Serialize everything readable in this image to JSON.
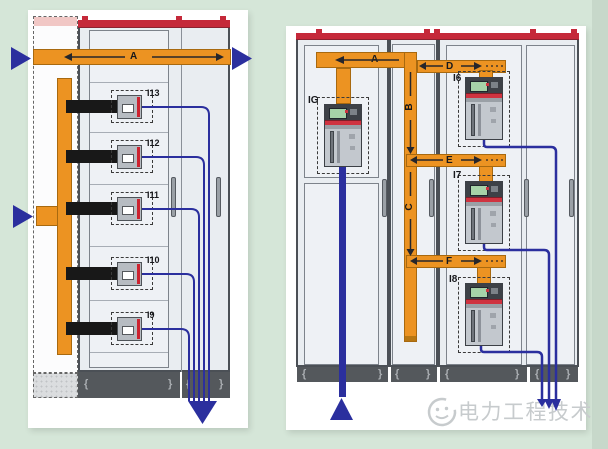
{
  "colors": {
    "background": "#d5e6d8",
    "busbar_orange": "#ec9322",
    "cable_blue": "#2b2f9e",
    "cabinet_red_strip": "#c5293a",
    "black_feeder": "#181818",
    "cabinet_fill": "#e9edf1"
  },
  "left_diagram": {
    "busbar_label": "A",
    "feeders": [
      {
        "label": "I13"
      },
      {
        "label": "I12"
      },
      {
        "label": "I11"
      },
      {
        "label": "I10"
      },
      {
        "label": "I9"
      }
    ]
  },
  "right_diagram": {
    "busbar_label": "A",
    "riser_label_b": "B",
    "riser_label_c": "C",
    "branch_label_d": "D",
    "branch_label_e": "E",
    "branch_label_f": "F",
    "incomer_label": "IG",
    "feeders": [
      {
        "label": "I6"
      },
      {
        "label": "I7"
      },
      {
        "label": "I8"
      }
    ]
  },
  "decorations": {
    "plinth_mark_open": "{",
    "plinth_mark_close": "}"
  },
  "watermark": {
    "text": "电力工程技术"
  }
}
